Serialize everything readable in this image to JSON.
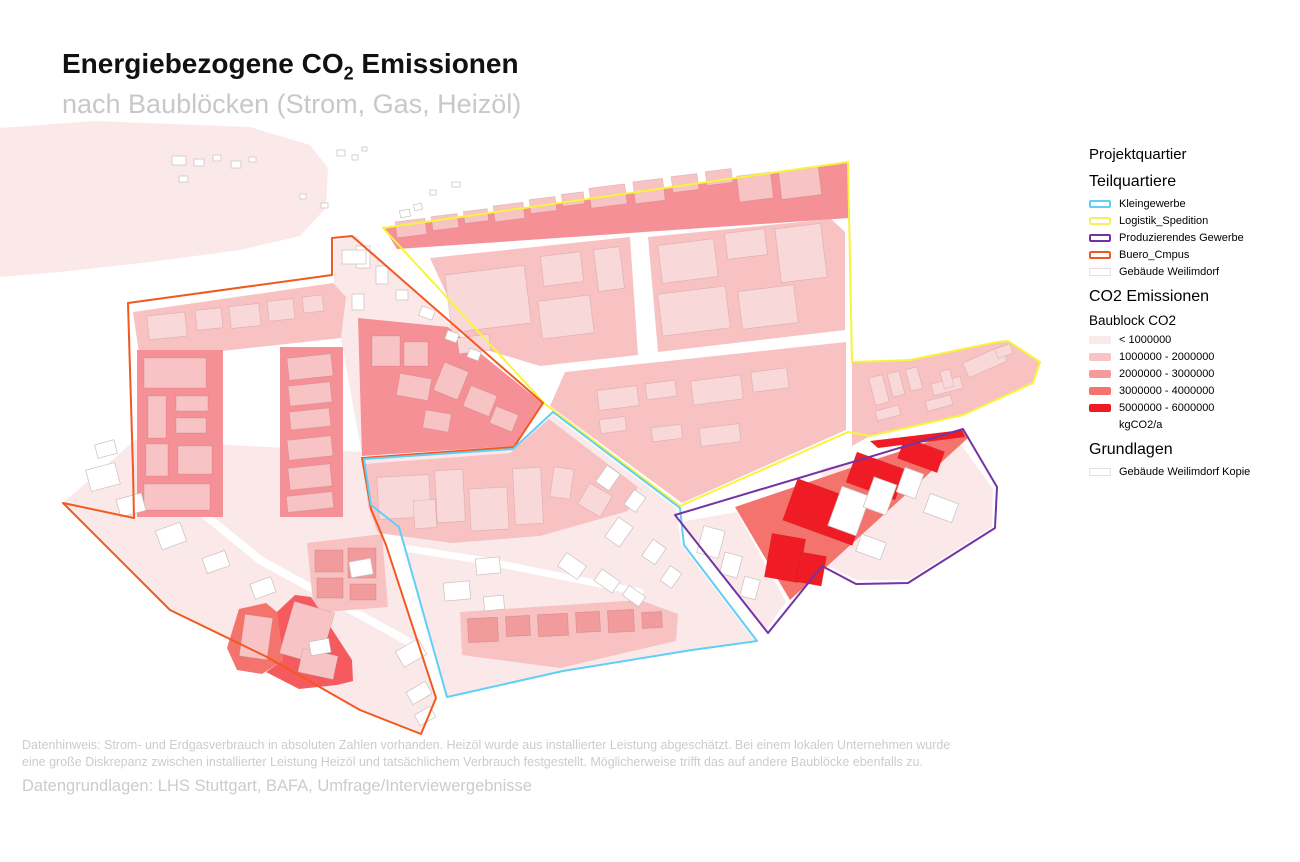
{
  "title": {
    "prefix": "Energiebezogene CO",
    "subscript": "2",
    "suffix": " Emissionen",
    "subtitle": "nach Baublöcken (Strom, Gas, Heizöl)"
  },
  "footer": {
    "note_line1": "Datenhinweis: Strom- und Erdgasverbrauch in absoluten Zahlen vorhanden. Heizöl wurde aus installierter Leistung abgeschätzt. Bei einem lokalen Unternehmen wurde",
    "note_line2": "eine große Diskrepanz zwischen installierter Leistung Heizöl und tatsächlichem Verbrauch festgestellt. Möglicherweise trifft das auf andere Baublöcke ebenfalls zu.",
    "sources": "Datengrundlagen: LHS Stuttgart, BAFA, Umfrage/Interviewergebnisse"
  },
  "legend": {
    "project_title": "Projektquartier",
    "teilquartiere": {
      "heading": "Teilquartiere",
      "items": [
        {
          "label": "Kleingewerbe",
          "color": "#5FCFF5",
          "swatch": "outline"
        },
        {
          "label": "Logistik_Spedition",
          "color": "#F5F15C",
          "swatch": "outline"
        },
        {
          "label": "Produzierendes Gewerbe",
          "color": "#7434A4",
          "swatch": "outline"
        },
        {
          "label": "Buero_Cmpus",
          "color": "#F2591F",
          "swatch": "outline"
        },
        {
          "label": "Gebäude Weilimdorf",
          "color": "#EADCDC",
          "swatch": "faint"
        }
      ]
    },
    "co2": {
      "heading": "CO2 Emissionen",
      "subheading": "Baublock CO2",
      "items": [
        {
          "label": "< 1000000",
          "color": "#FCE9E9",
          "swatch": "fill"
        },
        {
          "label": "1000000 - 2000000",
          "color": "#F8C3C2",
          "swatch": "fill"
        },
        {
          "label": "2000000 - 3000000",
          "color": "#F59B9B",
          "swatch": "fill"
        },
        {
          "label": "3000000 - 4000000",
          "color": "#F4746D",
          "swatch": "fill"
        },
        {
          "label": "5000000 - 6000000",
          "color": "#EF1C25",
          "swatch": "fill"
        }
      ],
      "unit": "kgCO2/a"
    },
    "grundlagen": {
      "heading": "Grundlagen",
      "items": [
        {
          "label": "Gebäude Weilimdorf Kopie",
          "color": "#EADCDC",
          "swatch": "faint"
        }
      ]
    }
  },
  "map": {
    "palette": {
      "blob": "#FBE9EA",
      "c0": "#FBE9EA",
      "c1": "#F8C2C3",
      "c2": "#F49096",
      "c3": "#F4746D",
      "c3d": "#F45A5E",
      "c4": "#EF1C25"
    },
    "tones": {
      "bw": {
        "fill": "#FFFFFF",
        "stroke": "#C9BFBF"
      },
      "b0": {
        "fill": "#F9D8D9",
        "stroke": "rgba(160,110,110,0.28)"
      },
      "b1": {
        "fill": "#F7C3C4",
        "stroke": "rgba(160,110,110,0.28)"
      },
      "b2": {
        "fill": "#F29B9C",
        "stroke": "rgba(150,90,90,0.3)"
      },
      "b4": {
        "fill": "#EF1C25",
        "stroke": "rgba(190,20,20,0.35)"
      }
    },
    "outline_colors": {
      "kleingewerbe": "#5FCFF5",
      "logistik_spedition": "#F7F43C",
      "produzierendes_gewerbe": "#7434A4",
      "buero_cmpus": "#F2591F"
    },
    "blob": "0,128 95,121 250,127 310,145 328,168 326,208 300,236 240,250 150,262 60,272 0,277",
    "base_blocks": [
      {
        "class": "c0",
        "points": "334,240 356,236 540,408 516,445 362,455 334,300"
      },
      {
        "class": "c0",
        "points": "63,503 135,440 362,452 372,508 386,545 436,698 421,734 360,710 267,657 170,610"
      },
      {
        "class": "c0",
        "points": "553,415 676,508 681,544 754,640 692,649 563,670 447,696 400,528 372,506 364,459 513,448"
      },
      {
        "class": "c0",
        "points": "822,468 958,440 993,489 992,527 908,580 857,580 824,564"
      },
      {
        "class": "c0",
        "points": "680,522 737,512 786,602 766,630"
      }
    ],
    "roads": [
      {
        "points": "150,470 260,560 420,648",
        "w": 8
      },
      {
        "points": "404,548 480,560 560,576 640,592",
        "w": 7
      }
    ],
    "blocks": [
      {
        "class": "c1",
        "points": "133,312 333,283 346,297 341,338 140,360"
      },
      {
        "class": "c1",
        "points": "430,258 630,237 638,355 540,366 470,345"
      },
      {
        "class": "c1",
        "points": "648,237 831,219 845,232 845,330 658,352"
      },
      {
        "class": "c1",
        "points": "565,372 846,342 846,430 682,503 550,406"
      },
      {
        "class": "c1",
        "points": "852,362 910,360 997,342 1008,341 1040,362 1033,383 963,415 870,436 852,446"
      },
      {
        "class": "c1",
        "points": "460,612 640,600 678,614 676,641 560,668 462,655"
      },
      {
        "class": "c1",
        "points": "307,543 382,534 388,607 314,613"
      },
      {
        "class": "c1",
        "points": "364,464 510,453 549,419 638,487 628,511 540,536 452,543 378,533 368,506"
      },
      {
        "class": "c2",
        "points": "137,350 223,350 223,517 137,517"
      },
      {
        "class": "c2",
        "points": "280,347 343,347 343,517 280,517"
      },
      {
        "class": "c2",
        "points": "358,318 448,327 543,404 514,446 362,456"
      },
      {
        "class": "c2",
        "points": "384,228 848,162 849,218 397,249"
      },
      {
        "class": "c3",
        "points": "227,648 239,609 266,603 277,612 283,660 262,674 237,670"
      },
      {
        "class": "c3d",
        "points": "277,612 295,595 311,597 352,660 353,681 337,685 299,689 266,672 283,660"
      },
      {
        "class": "c3",
        "points": "735,507 963,430 968,438 790,600"
      },
      {
        "class": "c4",
        "points": "870,441 962,430 965,437 878,448"
      }
    ],
    "buildings": [
      [
        "b0",
        148,
        314,
        38,
        24,
        -6
      ],
      [
        "b0",
        196,
        309,
        26,
        20,
        -6
      ],
      [
        "b0",
        230,
        305,
        30,
        22,
        -6
      ],
      [
        "b0",
        268,
        300,
        26,
        20,
        -6
      ],
      [
        "b0",
        303,
        296,
        20,
        16,
        -6
      ],
      [
        "b1",
        144,
        358,
        62,
        30,
        0
      ],
      [
        "b1",
        148,
        396,
        18,
        42,
        0
      ],
      [
        "b1",
        176,
        396,
        32,
        15,
        0
      ],
      [
        "b1",
        176,
        418,
        30,
        15,
        0
      ],
      [
        "b1",
        146,
        444,
        22,
        32,
        0
      ],
      [
        "b1",
        178,
        446,
        34,
        28,
        0
      ],
      [
        "b1",
        144,
        484,
        66,
        26,
        0
      ],
      [
        "b1",
        288,
        356,
        44,
        22,
        -6
      ],
      [
        "b1",
        289,
        384,
        42,
        20,
        -6
      ],
      [
        "b1",
        290,
        410,
        40,
        18,
        -6
      ],
      [
        "b1",
        288,
        438,
        44,
        20,
        -6
      ],
      [
        "b1",
        289,
        466,
        42,
        22,
        -6
      ],
      [
        "b1",
        287,
        494,
        46,
        16,
        -6
      ],
      [
        "b1",
        372,
        336,
        28,
        30,
        0
      ],
      [
        "b1",
        404,
        342,
        24,
        24,
        0
      ],
      [
        "b1",
        398,
        376,
        32,
        22,
        10
      ],
      [
        "b1",
        438,
        366,
        26,
        30,
        22
      ],
      [
        "b1",
        466,
        390,
        28,
        22,
        22
      ],
      [
        "b1",
        492,
        410,
        24,
        18,
        22
      ],
      [
        "b1",
        424,
        412,
        26,
        18,
        10
      ],
      [
        "b1",
        396,
        220,
        30,
        16,
        -7
      ],
      [
        "b1",
        432,
        215,
        26,
        14,
        -7
      ],
      [
        "b1",
        464,
        210,
        24,
        12,
        -7
      ],
      [
        "b1",
        494,
        204,
        30,
        16,
        -7
      ],
      [
        "b1",
        530,
        198,
        26,
        14,
        -7
      ],
      [
        "b1",
        562,
        193,
        22,
        12,
        -7
      ],
      [
        "b1",
        590,
        186,
        36,
        20,
        -7
      ],
      [
        "b1",
        634,
        180,
        30,
        22,
        -7
      ],
      [
        "b1",
        672,
        175,
        26,
        16,
        -7
      ],
      [
        "b1",
        706,
        170,
        26,
        14,
        -7
      ],
      [
        "b1",
        738,
        174,
        34,
        26,
        -7
      ],
      [
        "b1",
        780,
        169,
        40,
        28,
        -7
      ],
      [
        "b0",
        448,
        270,
        80,
        58,
        -7
      ],
      [
        "b0",
        542,
        254,
        40,
        30,
        -7
      ],
      [
        "b0",
        596,
        248,
        26,
        42,
        -7
      ],
      [
        "b0",
        458,
        336,
        32,
        16,
        -7
      ],
      [
        "b0",
        540,
        298,
        52,
        38,
        -7
      ],
      [
        "b0",
        660,
        242,
        56,
        38,
        -7
      ],
      [
        "b0",
        726,
        231,
        40,
        26,
        -7
      ],
      [
        "b0",
        778,
        226,
        46,
        54,
        -7
      ],
      [
        "b0",
        660,
        290,
        68,
        42,
        -7
      ],
      [
        "b0",
        740,
        288,
        56,
        38,
        -7
      ],
      [
        "b0",
        598,
        388,
        40,
        20,
        -7
      ],
      [
        "b0",
        646,
        382,
        30,
        16,
        -7
      ],
      [
        "b0",
        692,
        378,
        50,
        24,
        -7
      ],
      [
        "b0",
        752,
        370,
        36,
        20,
        -7
      ],
      [
        "b0",
        700,
        426,
        40,
        18,
        -7
      ],
      [
        "b0",
        652,
        426,
        30,
        14,
        -7
      ],
      [
        "b0",
        600,
        418,
        26,
        14,
        -7
      ],
      [
        "b0",
        872,
        376,
        14,
        28,
        -15
      ],
      [
        "b0",
        890,
        372,
        12,
        24,
        -15
      ],
      [
        "b0",
        908,
        368,
        12,
        22,
        -15
      ],
      [
        "b0",
        932,
        380,
        30,
        12,
        -15
      ],
      [
        "b0",
        964,
        354,
        42,
        16,
        -24
      ],
      [
        "b0",
        996,
        346,
        16,
        10,
        -20
      ],
      [
        "b0",
        926,
        398,
        26,
        10,
        -15
      ],
      [
        "b0",
        876,
        408,
        24,
        10,
        -15
      ],
      [
        "b0",
        942,
        370,
        10,
        18,
        -15
      ],
      [
        "b0",
        378,
        476,
        52,
        42,
        -3
      ],
      [
        "b0",
        436,
        470,
        28,
        52,
        -3
      ],
      [
        "b0",
        470,
        488,
        38,
        42,
        -3
      ],
      [
        "b0",
        514,
        468,
        28,
        56,
        -3
      ],
      [
        "b0",
        414,
        500,
        22,
        28,
        -3
      ],
      [
        "b0",
        552,
        468,
        20,
        30,
        8
      ],
      [
        "b0",
        582,
        488,
        26,
        24,
        30
      ],
      [
        "b2",
        468,
        618,
        30,
        24,
        -3
      ],
      [
        "b2",
        506,
        616,
        24,
        20,
        -3
      ],
      [
        "b2",
        538,
        614,
        30,
        22,
        -3
      ],
      [
        "b2",
        576,
        612,
        24,
        20,
        -3
      ],
      [
        "b2",
        608,
        610,
        26,
        22,
        -3
      ],
      [
        "b2",
        642,
        612,
        20,
        16,
        -3
      ],
      [
        "b2",
        315,
        550,
        28,
        22,
        0
      ],
      [
        "b2",
        317,
        578,
        26,
        20,
        0
      ],
      [
        "b2",
        348,
        548,
        28,
        30,
        0
      ],
      [
        "b2",
        350,
        584,
        26,
        16,
        0
      ],
      [
        "b1",
        242,
        616,
        28,
        42,
        8
      ],
      [
        "b1",
        286,
        606,
        42,
        54,
        16
      ],
      [
        "b1",
        300,
        652,
        36,
        24,
        12
      ],
      [
        "b4",
        788,
        490,
        74,
        44,
        20
      ],
      [
        "b4",
        850,
        460,
        52,
        32,
        20
      ],
      [
        "b4",
        900,
        444,
        42,
        22,
        20
      ],
      [
        "b4",
        768,
        536,
        34,
        44,
        10
      ],
      [
        "b4",
        798,
        554,
        26,
        30,
        10
      ],
      [
        "bw",
        834,
        490,
        30,
        42,
        20
      ],
      [
        "bw",
        868,
        480,
        24,
        32,
        20
      ],
      [
        "bw",
        900,
        470,
        20,
        26,
        20
      ],
      [
        "bw",
        926,
        498,
        30,
        20,
        20
      ],
      [
        "bw",
        858,
        538,
        26,
        18,
        20
      ],
      [
        "bw",
        700,
        528,
        22,
        28,
        15
      ],
      [
        "bw",
        722,
        554,
        18,
        22,
        15
      ],
      [
        "bw",
        742,
        578,
        16,
        20,
        15
      ],
      [
        "bw",
        88,
        466,
        30,
        22,
        -15
      ],
      [
        "bw",
        118,
        496,
        26,
        18,
        -15
      ],
      [
        "bw",
        158,
        526,
        26,
        20,
        -20
      ],
      [
        "bw",
        204,
        554,
        24,
        16,
        -20
      ],
      [
        "bw",
        252,
        580,
        22,
        16,
        -20
      ],
      [
        "bw",
        96,
        442,
        20,
        14,
        -15
      ],
      [
        "bw",
        398,
        644,
        26,
        18,
        -30
      ],
      [
        "bw",
        408,
        686,
        22,
        14,
        -30
      ],
      [
        "bw",
        416,
        710,
        18,
        12,
        -30
      ],
      [
        "bw",
        350,
        560,
        22,
        16,
        -10
      ],
      [
        "bw",
        310,
        640,
        20,
        14,
        -10
      ],
      [
        "bw",
        476,
        558,
        24,
        16,
        -5
      ],
      [
        "bw",
        444,
        582,
        26,
        18,
        -5
      ],
      [
        "bw",
        484,
        596,
        20,
        14,
        -5
      ],
      [
        "bw",
        560,
        558,
        24,
        16,
        35
      ],
      [
        "bw",
        596,
        574,
        22,
        14,
        35
      ],
      [
        "bw",
        624,
        590,
        20,
        12,
        35
      ],
      [
        "bw",
        610,
        520,
        18,
        24,
        35
      ],
      [
        "bw",
        646,
        542,
        16,
        20,
        35
      ],
      [
        "bw",
        664,
        568,
        14,
        18,
        35
      ],
      [
        "bw",
        600,
        468,
        16,
        20,
        35
      ],
      [
        "bw",
        628,
        492,
        14,
        18,
        35
      ],
      [
        "bw",
        356,
        246,
        14,
        22,
        0
      ],
      [
        "bw",
        376,
        266,
        12,
        18,
        0
      ],
      [
        "bw",
        352,
        294,
        12,
        16,
        0
      ],
      [
        "bw",
        396,
        290,
        12,
        10,
        0
      ],
      [
        "bw",
        420,
        308,
        14,
        10,
        20
      ],
      [
        "bw",
        446,
        332,
        12,
        9,
        20
      ],
      [
        "bw",
        468,
        350,
        12,
        9,
        20
      ],
      [
        "bw",
        342,
        250,
        24,
        14,
        0
      ],
      [
        "bw",
        172,
        156,
        14,
        9,
        0
      ],
      [
        "bw",
        194,
        159,
        10,
        7,
        0
      ],
      [
        "bw",
        213,
        155,
        8,
        6,
        0
      ],
      [
        "bw",
        231,
        161,
        10,
        7,
        0
      ],
      [
        "bw",
        249,
        157,
        7,
        5,
        0
      ],
      [
        "bw",
        179,
        176,
        9,
        6,
        0
      ],
      [
        "bw",
        337,
        150,
        8,
        6,
        0
      ],
      [
        "bw",
        352,
        155,
        6,
        5,
        0
      ],
      [
        "bw",
        362,
        147,
        5,
        4,
        0
      ],
      [
        "bw",
        321,
        203,
        7,
        5,
        0
      ],
      [
        "bw",
        300,
        194,
        6,
        5,
        0
      ],
      [
        "bw",
        400,
        210,
        10,
        7,
        -10
      ],
      [
        "bw",
        414,
        204,
        8,
        6,
        -10
      ],
      [
        "bw",
        430,
        190,
        6,
        5,
        0
      ],
      [
        "bw",
        452,
        182,
        8,
        5,
        0
      ]
    ],
    "outlines": [
      {
        "name": "logistik_spedition",
        "points": "383,228 848,162 852,362 910,360 997,342 1008,341 1040,362 1033,383 963,415 870,436 848,432 680,506 545,404"
      },
      {
        "name": "buero_cmpus",
        "points": "352,236 543,403 514,447 362,458 371,509 386,545 436,698 421,734 360,710 267,657 170,610 63,503 134,518 133,470 128,303 332,275 332,238"
      },
      {
        "name": "kleingewerbe",
        "points": "553,412 680,508 684,545 757,641 692,650 563,671 447,697 399,527 371,505 364,459 513,449"
      },
      {
        "name": "produzierendes_gewerbe",
        "points": "675,515 963,429 997,487 995,528 908,583 856,584 822,566 768,633"
      }
    ]
  }
}
